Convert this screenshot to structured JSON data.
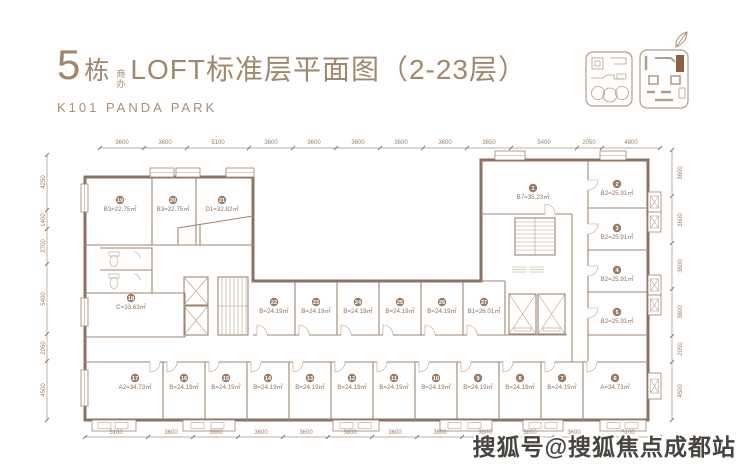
{
  "header": {
    "building_number": "5",
    "building_suffix": "栋",
    "badge_line1": "商",
    "badge_line2": "办",
    "title": "LOFT标准层平面图（2-23层）",
    "subtitle": "K101 PANDA PARK"
  },
  "watermark": "搜狐号@搜狐焦点成都站",
  "colors": {
    "brand_brown": "#a1876c",
    "wall_brown": "#8d7260",
    "unit_badge_brown": "#9b7c63",
    "keymap_highlight": "#8c5f45",
    "watermark_gray": "#47433f"
  },
  "dimensions": {
    "top": [
      "3600",
      "3600",
      "5100",
      "3600",
      "3600",
      "3600",
      "3600",
      "3600",
      "3650",
      "5400",
      "2050",
      "4800"
    ],
    "bottom": [
      "5100",
      "3600",
      "3600",
      "3600",
      "3600",
      "3600",
      "3600",
      "3600",
      "3600",
      "3600",
      "3600",
      "5100"
    ],
    "left": [
      "4250",
      "1400",
      "2700",
      "5400",
      "2050",
      "4500"
    ],
    "right": [
      "3600",
      "3600",
      "3600",
      "3600",
      "2050",
      "4500"
    ]
  },
  "units": {
    "u1": {
      "no": "1",
      "area": "B7=35.23㎡"
    },
    "u2": {
      "no": "2",
      "area": "B2=25.91㎡"
    },
    "u3": {
      "no": "3",
      "area": "B2=25.91㎡"
    },
    "u4": {
      "no": "4",
      "area": "B2=25.91㎡"
    },
    "u5": {
      "no": "5",
      "area": "B2=25.91㎡"
    },
    "u6": {
      "no": "6",
      "area": "A=34.73㎡"
    },
    "u7": {
      "no": "7",
      "area": "B=24.19㎡"
    },
    "u8": {
      "no": "8",
      "area": "B=24.19㎡"
    },
    "u9": {
      "no": "9",
      "area": "B=24.19㎡"
    },
    "u10": {
      "no": "10",
      "area": "B=24.19㎡"
    },
    "u11": {
      "no": "11",
      "area": "B=24.19㎡"
    },
    "u12": {
      "no": "12",
      "area": "B=24.19㎡"
    },
    "u13": {
      "no": "13",
      "area": "B=24.19㎡"
    },
    "u14": {
      "no": "14",
      "area": "B=24.19㎡"
    },
    "u15": {
      "no": "15",
      "area": "B=24.19㎡"
    },
    "u16": {
      "no": "16",
      "area": "B=24.19㎡"
    },
    "u17": {
      "no": "17",
      "area": "A2=34.73㎡"
    },
    "u18": {
      "no": "18",
      "area": "C=33.63㎡"
    },
    "u19": {
      "no": "19",
      "area": "B3=22.75㎡"
    },
    "u20": {
      "no": "20",
      "area": "B3=22.75㎡"
    },
    "u21": {
      "no": "21",
      "area": "D1=32.82㎡"
    },
    "u22": {
      "no": "22",
      "area": "B=24.19㎡"
    },
    "u23": {
      "no": "23",
      "area": "B=24.19㎡"
    },
    "u24": {
      "no": "24",
      "area": "B=24.19㎡"
    },
    "u25": {
      "no": "25",
      "area": "B=24.19㎡"
    },
    "u26": {
      "no": "26",
      "area": "B=24.19㎡"
    },
    "u27": {
      "no": "27",
      "area": "B1=26.01㎡"
    }
  }
}
